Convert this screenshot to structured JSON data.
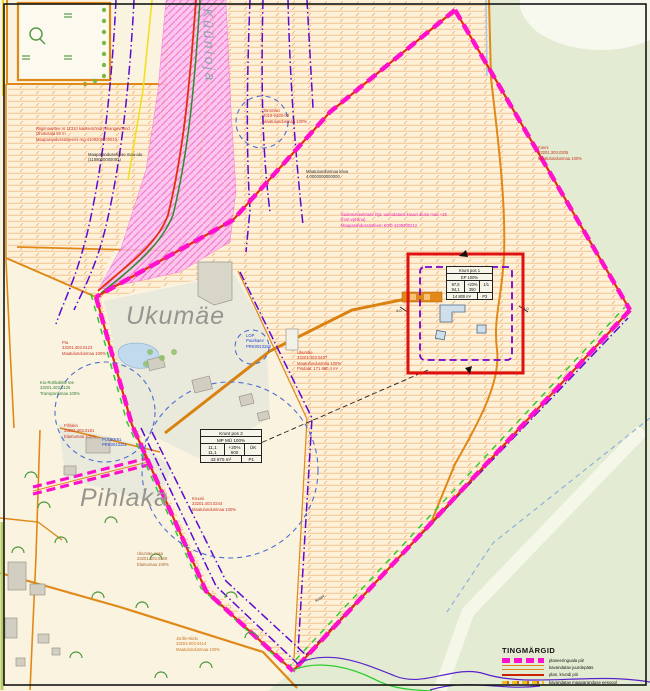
{
  "palette": {
    "cream": "#faf3e0",
    "green_area": "#e3ecd2",
    "hatch_line": "#f0b273",
    "pink_corridor": "#fcc0ee",
    "magenta_boundary": "#ff10cc",
    "red_line": "#e03010",
    "orange_line": "#e08818",
    "purple_dashdot": "#5a0ad2",
    "yellow_line": "#f0e020",
    "blue_circle": "#4d6fd0",
    "red_square": "#e01010",
    "pale_green_strip": "#f5f7e9"
  },
  "place_names_note": "gray italic toponyms and rotated stream name",
  "labels": [
    {
      "id": "kyynioja-name",
      "lines": [
        "Küünioja"
      ],
      "x": 216,
      "y": 8,
      "color": "#8fa3b3",
      "size": 14,
      "italic": true,
      "rotate": 88,
      "ls": 2.5
    },
    {
      "id": "ukumae-name",
      "lines": [
        "Ukumäe"
      ],
      "x": 126,
      "y": 300,
      "color": "#97958f",
      "size": 25,
      "italic": true,
      "ls": 1
    },
    {
      "id": "pihlaka-name",
      "lines": [
        "Pihlaka"
      ],
      "x": 80,
      "y": 482,
      "color": "#97958f",
      "size": 25,
      "italic": true,
      "ls": 1
    },
    {
      "id": "riigitee-note",
      "lines": [
        "Riigimaantee nr 11310 kaitsevööndi piiranguvöönd",
        "Ohutusala 50 m",
        "Maaparandussüsteemi reg 4109200200010"
      ],
      "x": 36,
      "y": 126,
      "color": "#cc3322",
      "size": 4.2
    },
    {
      "id": "maaparandus-note",
      "lines": [
        "Maaparandusehitise maa-ala",
        "(1188000000001)"
      ],
      "x": 88,
      "y": 152,
      "color": "#333333",
      "size": 4.2
    },
    {
      "id": "tammiku-parcel",
      "lines": [
        "Tammiku",
        "2019-0430-03",
        "Maatulundusmaa 100%"
      ],
      "x": 263,
      "y": 108,
      "color": "#cc3322",
      "size": 4.2
    },
    {
      "id": "fanni-parcel",
      "lines": [
        "Fanni",
        "33201.303.0305",
        "Maatulundusmaa 100%"
      ],
      "x": 538,
      "y": 145,
      "color": "#cc3322",
      "size": 4.2
    },
    {
      "id": "maakava-note",
      "lines": [
        "Maatulundusmaa kava",
        "4 0000000000000"
      ],
      "x": 306,
      "y": 169,
      "color": "#333333",
      "size": 4.2
    },
    {
      "id": "sademevee-note",
      "lines": [
        "Sademeveekraav Oja: uuendatava kraavi alune maa +25",
        "(mnt vpl anu)",
        "Maaparandussüsteem KOD 4109200212"
      ],
      "x": 341,
      "y": 212,
      "color": "#ee22bb",
      "size": 4.2
    },
    {
      "id": "ukumae-parcel",
      "lines": [
        "Ukumäe",
        "33201.403.0427",
        "Maatulundusmaa 100%",
        "Pindala: 171 860,4 m²"
      ],
      "x": 297,
      "y": 350,
      "color": "#cc3322",
      "size": 4.2
    },
    {
      "id": "pia-parcel",
      "lines": [
        "Pia",
        "33201.403.0123",
        "Maatulundusmaa 100%"
      ],
      "x": 62,
      "y": 340,
      "color": "#cc3322",
      "size": 4.2
    },
    {
      "id": "kiu-tee-parcel",
      "lines": [
        "Kiu-Ruhkaliste tee",
        "33201.403.0126",
        "Transpordimaa 100%"
      ],
      "x": 40,
      "y": 380,
      "color": "#2e7d32",
      "size": 4.2
    },
    {
      "id": "pihlaka-parcel",
      "lines": [
        "Pihlaka",
        "33201.403.0181",
        "Elamumaa 100%"
      ],
      "x": 64,
      "y": 423,
      "color": "#cc3322",
      "size": 4.2
    },
    {
      "id": "puurk-label",
      "lines": [
        "PUURK81",
        "PRK0013151"
      ],
      "x": 102,
      "y": 437,
      "color": "#2244cc",
      "size": 4.2
    },
    {
      "id": "lop-label",
      "lines": [
        "LOP",
        "Puurkaev",
        "PRK0013150"
      ],
      "x": 246,
      "y": 333,
      "color": "#2244cc",
      "size": 4.2
    },
    {
      "id": "kruusi-parcel",
      "lines": [
        "Kruusi",
        "33201.403.0244",
        "Maatulundusmaa 100%"
      ],
      "x": 192,
      "y": 496,
      "color": "#cc3322",
      "size": 4.2
    },
    {
      "id": "ukumae-aasa-parcel",
      "lines": [
        "Ukumäe Aasa",
        "33201.403.0406",
        "Elamumaa 100%"
      ],
      "x": 137,
      "y": 551,
      "color": "#aa6633",
      "size": 4.2
    },
    {
      "id": "jyrille-parcel",
      "lines": [
        "Jürille-Niidu",
        "33204.003.0414",
        "Maatulundusmaa 100%"
      ],
      "x": 176,
      "y": 636,
      "color": "#cc7722",
      "size": 4.2
    },
    {
      "id": "kraav-note",
      "lines": [
        "Kraav"
      ],
      "x": 314,
      "y": 599,
      "color": "#222222",
      "size": 4,
      "rotate": -35
    },
    {
      "id": "dim-left",
      "lines": [
        "4.0"
      ],
      "x": 396,
      "y": 308,
      "color": "#222222",
      "size": 4
    },
    {
      "id": "dim-right",
      "lines": [
        "4.0"
      ],
      "x": 523,
      "y": 306,
      "color": "#222222",
      "size": 4
    }
  ],
  "tables": [
    {
      "id": "krunt-pos-1",
      "x": 446,
      "y": 266,
      "w": 47,
      "font": 4.1,
      "title": "Krunt pos 1",
      "landuse": "EP 100%",
      "col1": [
        "97,5",
        "94,1"
      ],
      "col2": [
        "+20%",
        "350"
      ],
      "col3": [
        "1/1"
      ],
      "area": "14 800 m²",
      "zone": "P3"
    },
    {
      "id": "krunt-pos-2",
      "x": 200,
      "y": 429,
      "w": 62,
      "font": 4.6,
      "title": "Krunt pos 2",
      "landuse": "MP MÜ 100%",
      "col1": [
        "11,1",
        "11,1"
      ],
      "col2": [
        "+20%",
        "600"
      ],
      "col3": [
        "ÜK"
      ],
      "area": "43 675 m²",
      "zone": "P1"
    }
  ],
  "legend": {
    "title": "TINGMÄRGID",
    "items": [
      {
        "id": "planeeringuala-piir",
        "swatch": "magenta-dash",
        "label": "planeeringuala piir"
      },
      {
        "id": "kavandatav-juurdepaas",
        "swatch": "orange-double",
        "label": "kavandatav juurdepääs"
      },
      {
        "id": "plan-krundi-piir",
        "swatch": "red-line",
        "label": "plan. krundi piir"
      },
      {
        "id": "kavandatav-eesvool",
        "swatch": "yellow-dash",
        "label": "kavandatav maaparanduse eesvool"
      }
    ]
  }
}
